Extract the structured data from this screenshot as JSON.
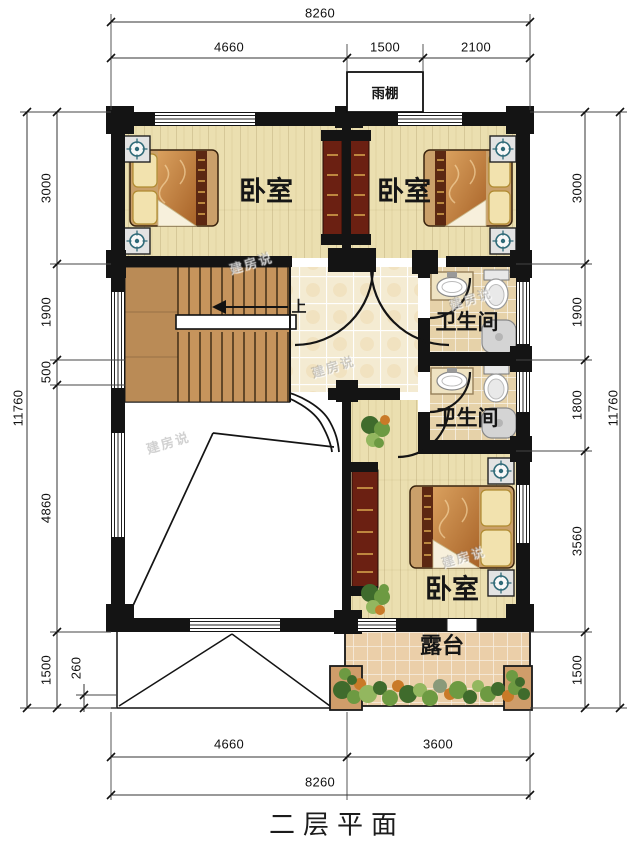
{
  "meta": {
    "title": "二层平面",
    "watermark": "建房说"
  },
  "rooms": {
    "bedroom_top_left": "卧室",
    "bedroom_top_right": "卧室",
    "bedroom_bottom": "卧室",
    "bathroom_upper": "卫生间",
    "bathroom_lower": "卫生间",
    "canopy": "雨棚",
    "terrace": "露台",
    "stair_direction": "上"
  },
  "dimensions": {
    "top": {
      "total": "8260",
      "segments": [
        "4660",
        "1500",
        "2100"
      ]
    },
    "bottom": {
      "total": "8260",
      "segments": [
        "4660",
        "3600"
      ]
    },
    "left": {
      "total": "11760",
      "segments": [
        "3000",
        "1900",
        "500",
        "4860",
        "1500"
      ],
      "inner": "260"
    },
    "right": {
      "total": "11760",
      "segments": [
        "3000",
        "1900",
        "1800",
        "3560",
        "1500"
      ]
    }
  },
  "colors": {
    "wall": "#141414",
    "wood_floor": "#ebdfb0",
    "tile_floor": "#f4ebd2",
    "bath_floor": "#e6d2a9",
    "terrace_tile": "#ebcfa9",
    "stair_wood": "#c6945c",
    "wardrobe": "#6b2012",
    "bed_quilt_dark": "#a86328",
    "bed_quilt_light": "#d9a05e",
    "plant_green": "#5f8f3e"
  }
}
